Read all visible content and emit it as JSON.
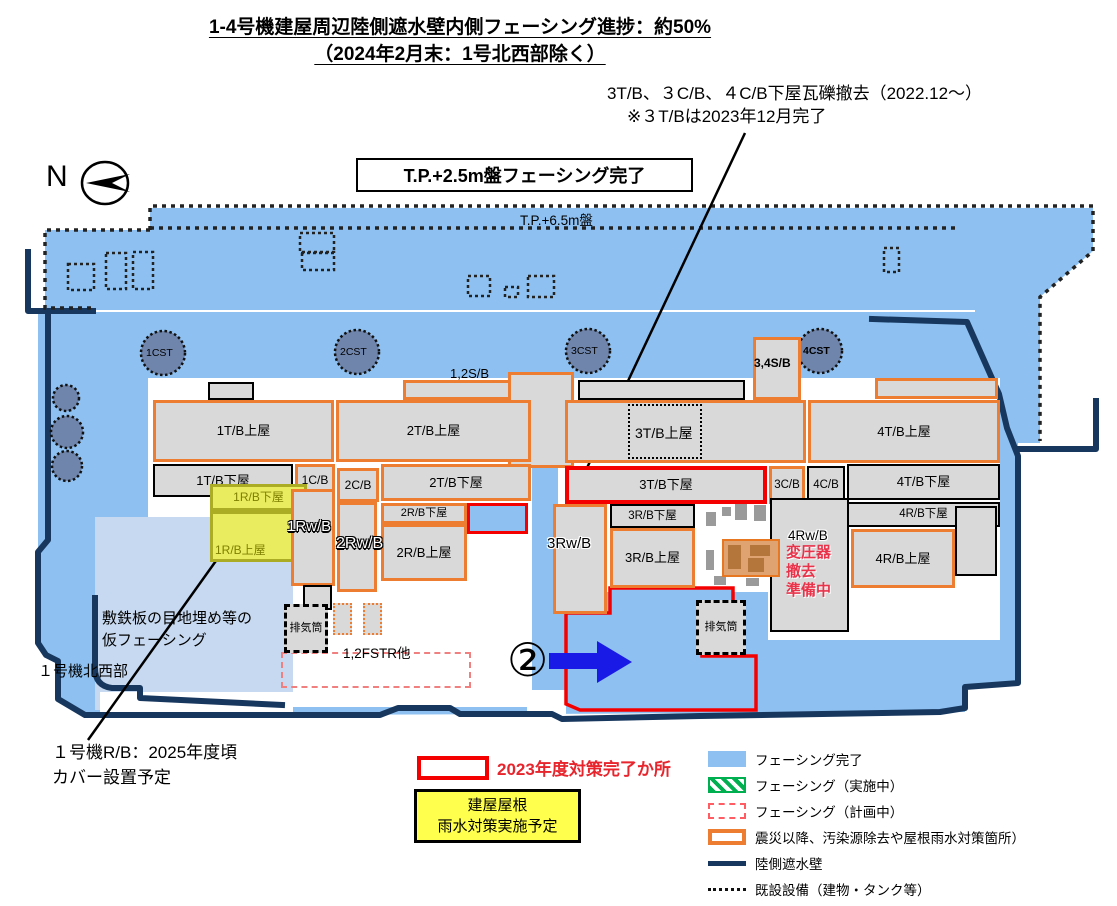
{
  "title": {
    "line1": "1-4号機建屋周辺陸側遮水壁内側フェーシング進捗：約50%",
    "line2": "（2024年2月末：1号北西部除く）"
  },
  "notes": {
    "debris_line1": "3T/B、３C/B、４C/B下屋瓦礫撤去（2022.12～）",
    "debris_line2": "※３T/Bは2023年12月完了",
    "tp25_banner": "T.P.+2.5m盤フェーシング完了",
    "tp65_label": "T.P.+6.5m盤",
    "north": "N",
    "step_marker": "②",
    "transformer_line1": "変圧器",
    "transformer_line2": "撤去",
    "transformer_line3": "準備中",
    "temp_facing_line1": "敷鉄板の目地埋め等の",
    "temp_facing_line2": "仮フェーシング",
    "unit1_nw": "１号機北西部",
    "rb_cover_line1": "１号機R/B：2025年度頃",
    "rb_cover_line2": "カバー設置予定"
  },
  "buildings": {
    "u12sb": "1,2S/B",
    "u1tb_upper": "1T/B上屋",
    "u2tb_upper": "2T/B上屋",
    "u1tb_lower": "1T/B下屋",
    "u1cb": "1C/B",
    "u2cb": "2C/B",
    "u2tb_lower": "2T/B下屋",
    "u1rb_lower": "1R/B下屋",
    "u1rb_upper": "1R/B上屋",
    "u1rwb": "1Rw/B",
    "u2rwb": "2Rw/B",
    "u2rb_lower": "2R/B下屋",
    "u2rb_upper": "2R/B上屋",
    "stack1": "排気筒",
    "u12fstr": "1,2FSTR他",
    "u34sb": "3,4S/B",
    "u3tb_upper": "3T/B上屋",
    "u4tb_upper": "4T/B上屋",
    "u3tb_lower": "3T/B下屋",
    "u3cb": "3C/B",
    "u4cb": "4C/B",
    "u4tb_lower": "4T/B下屋",
    "u3rb_lower": "3R/B下屋",
    "u3rb_upper": "3R/B上屋",
    "u3rwb": "3Rw/B",
    "u4rwb": "4Rw/B",
    "u4rb_lower": "4R/B下屋",
    "u4rb_upper": "4R/B上屋",
    "stack2": "排気筒"
  },
  "tanks": {
    "cst1": "1CST",
    "cst2": "2CST",
    "cst3": "3CST",
    "cst4": "4CST"
  },
  "legend": {
    "completed_2023": "2023年度対策完了か所",
    "roof_line1": "建屋屋根",
    "roof_line2": "雨水対策実施予定",
    "items": [
      {
        "swatch": "blue-fill",
        "label": "フェーシング完了"
      },
      {
        "swatch": "green-hatch",
        "label": "フェーシング（実施中）"
      },
      {
        "swatch": "red-dashed",
        "label": "フェーシング（計画中）"
      },
      {
        "swatch": "orange-outline",
        "label": "震災以降、汚染源除去や屋根雨水対策箇所）"
      },
      {
        "swatch": "navy-line",
        "label": "陸側遮水壁"
      },
      {
        "swatch": "dotted-line",
        "label": "既設設備（建物・タンク等）"
      }
    ]
  },
  "colors": {
    "facing_complete": "#8EC1F1",
    "temp_facing": "#C7D9F0",
    "wall_navy": "#17375E",
    "countermeasure_orange": "#ED7D31",
    "completed_red": "#F50000",
    "roof_yellow": "#FFFF4D",
    "in_progress_green": "#00B050",
    "tank_fill": "#6F85AC"
  }
}
